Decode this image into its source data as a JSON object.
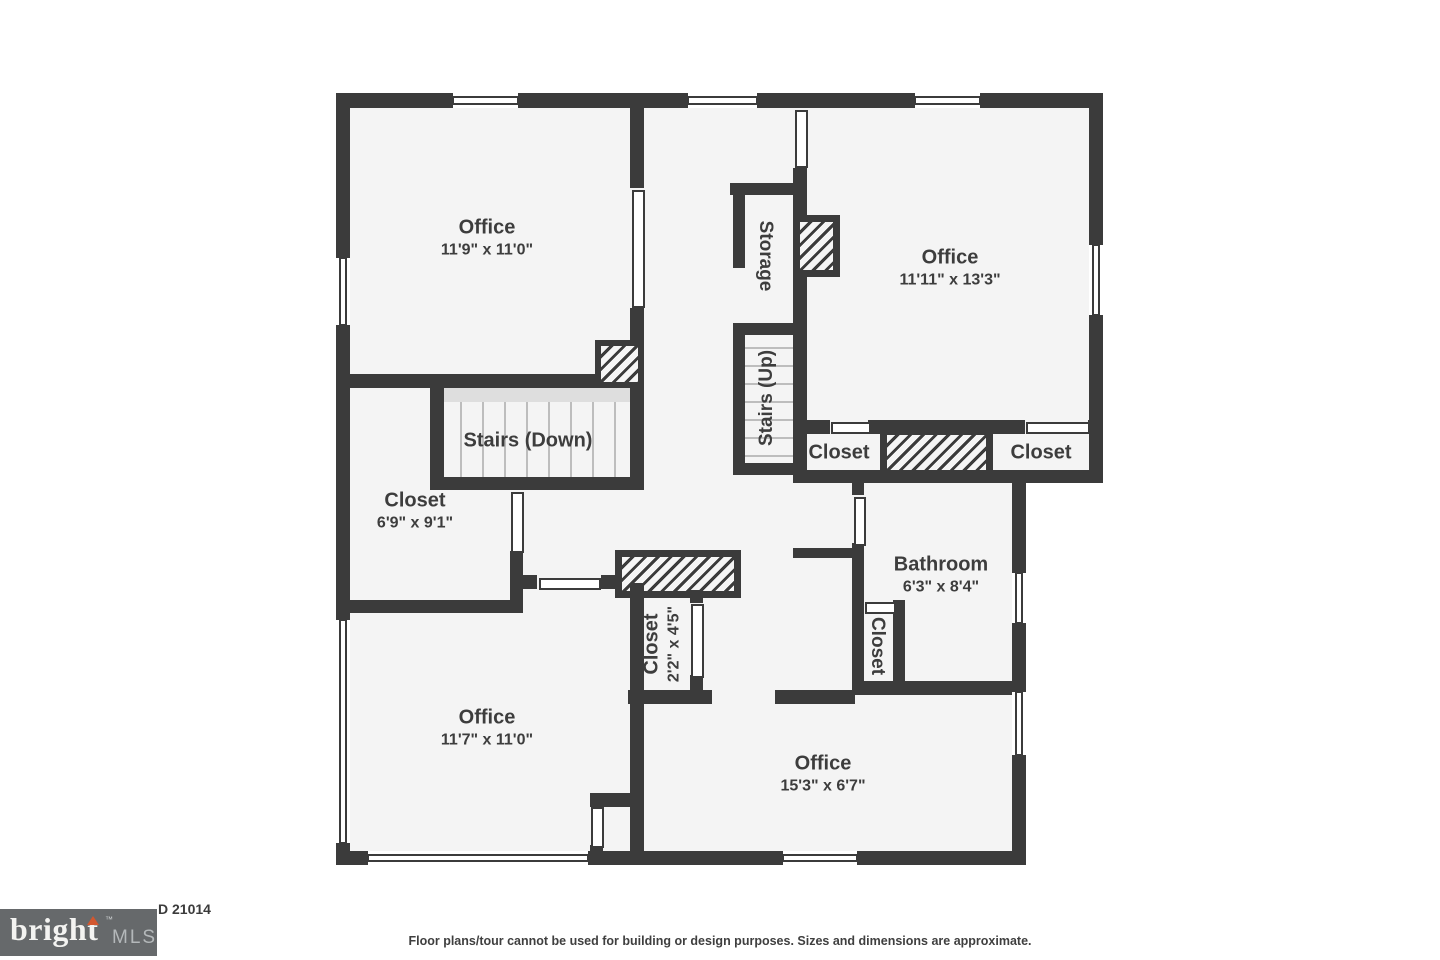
{
  "plan": {
    "rooms": {
      "office_tl": {
        "name": "Office",
        "dims": "11'9\" x 11'0\""
      },
      "office_tr": {
        "name": "Office",
        "dims": "11'11\" x 13'3\""
      },
      "closet_main": {
        "name": "Closet",
        "dims": "6'9\" x 9'1\""
      },
      "bathroom": {
        "name": "Bathroom",
        "dims": "6'3\" x 8'4\""
      },
      "office_bl": {
        "name": "Office",
        "dims": "11'7\" x 11'0\""
      },
      "office_br": {
        "name": "Office",
        "dims": "15'3\" x 6'7\""
      },
      "closet_small": {
        "name": "Closet",
        "dims": "2'2\" x 4'5\""
      },
      "storage": {
        "name": "Storage"
      },
      "stairs_down": {
        "name": "Stairs (Down)"
      },
      "stairs_up": {
        "name": "Stairs (Up)"
      },
      "closet_row_left": {
        "name": "Closet"
      },
      "closet_row_right": {
        "name": "Closet"
      },
      "closet_bath": {
        "name": "Closet"
      }
    }
  },
  "footer": {
    "address_fragment": "D 21014",
    "disclaimer": "Floor plans/tour cannot be used for building or design purposes. Sizes and dimensions are approximate.",
    "logo": {
      "brand": "bright",
      "tm": "™",
      "suffix": "MLS"
    }
  },
  "colors": {
    "wall": "#3b3b3b",
    "floor": "#f4f4f4",
    "accent": "#d2572f"
  }
}
